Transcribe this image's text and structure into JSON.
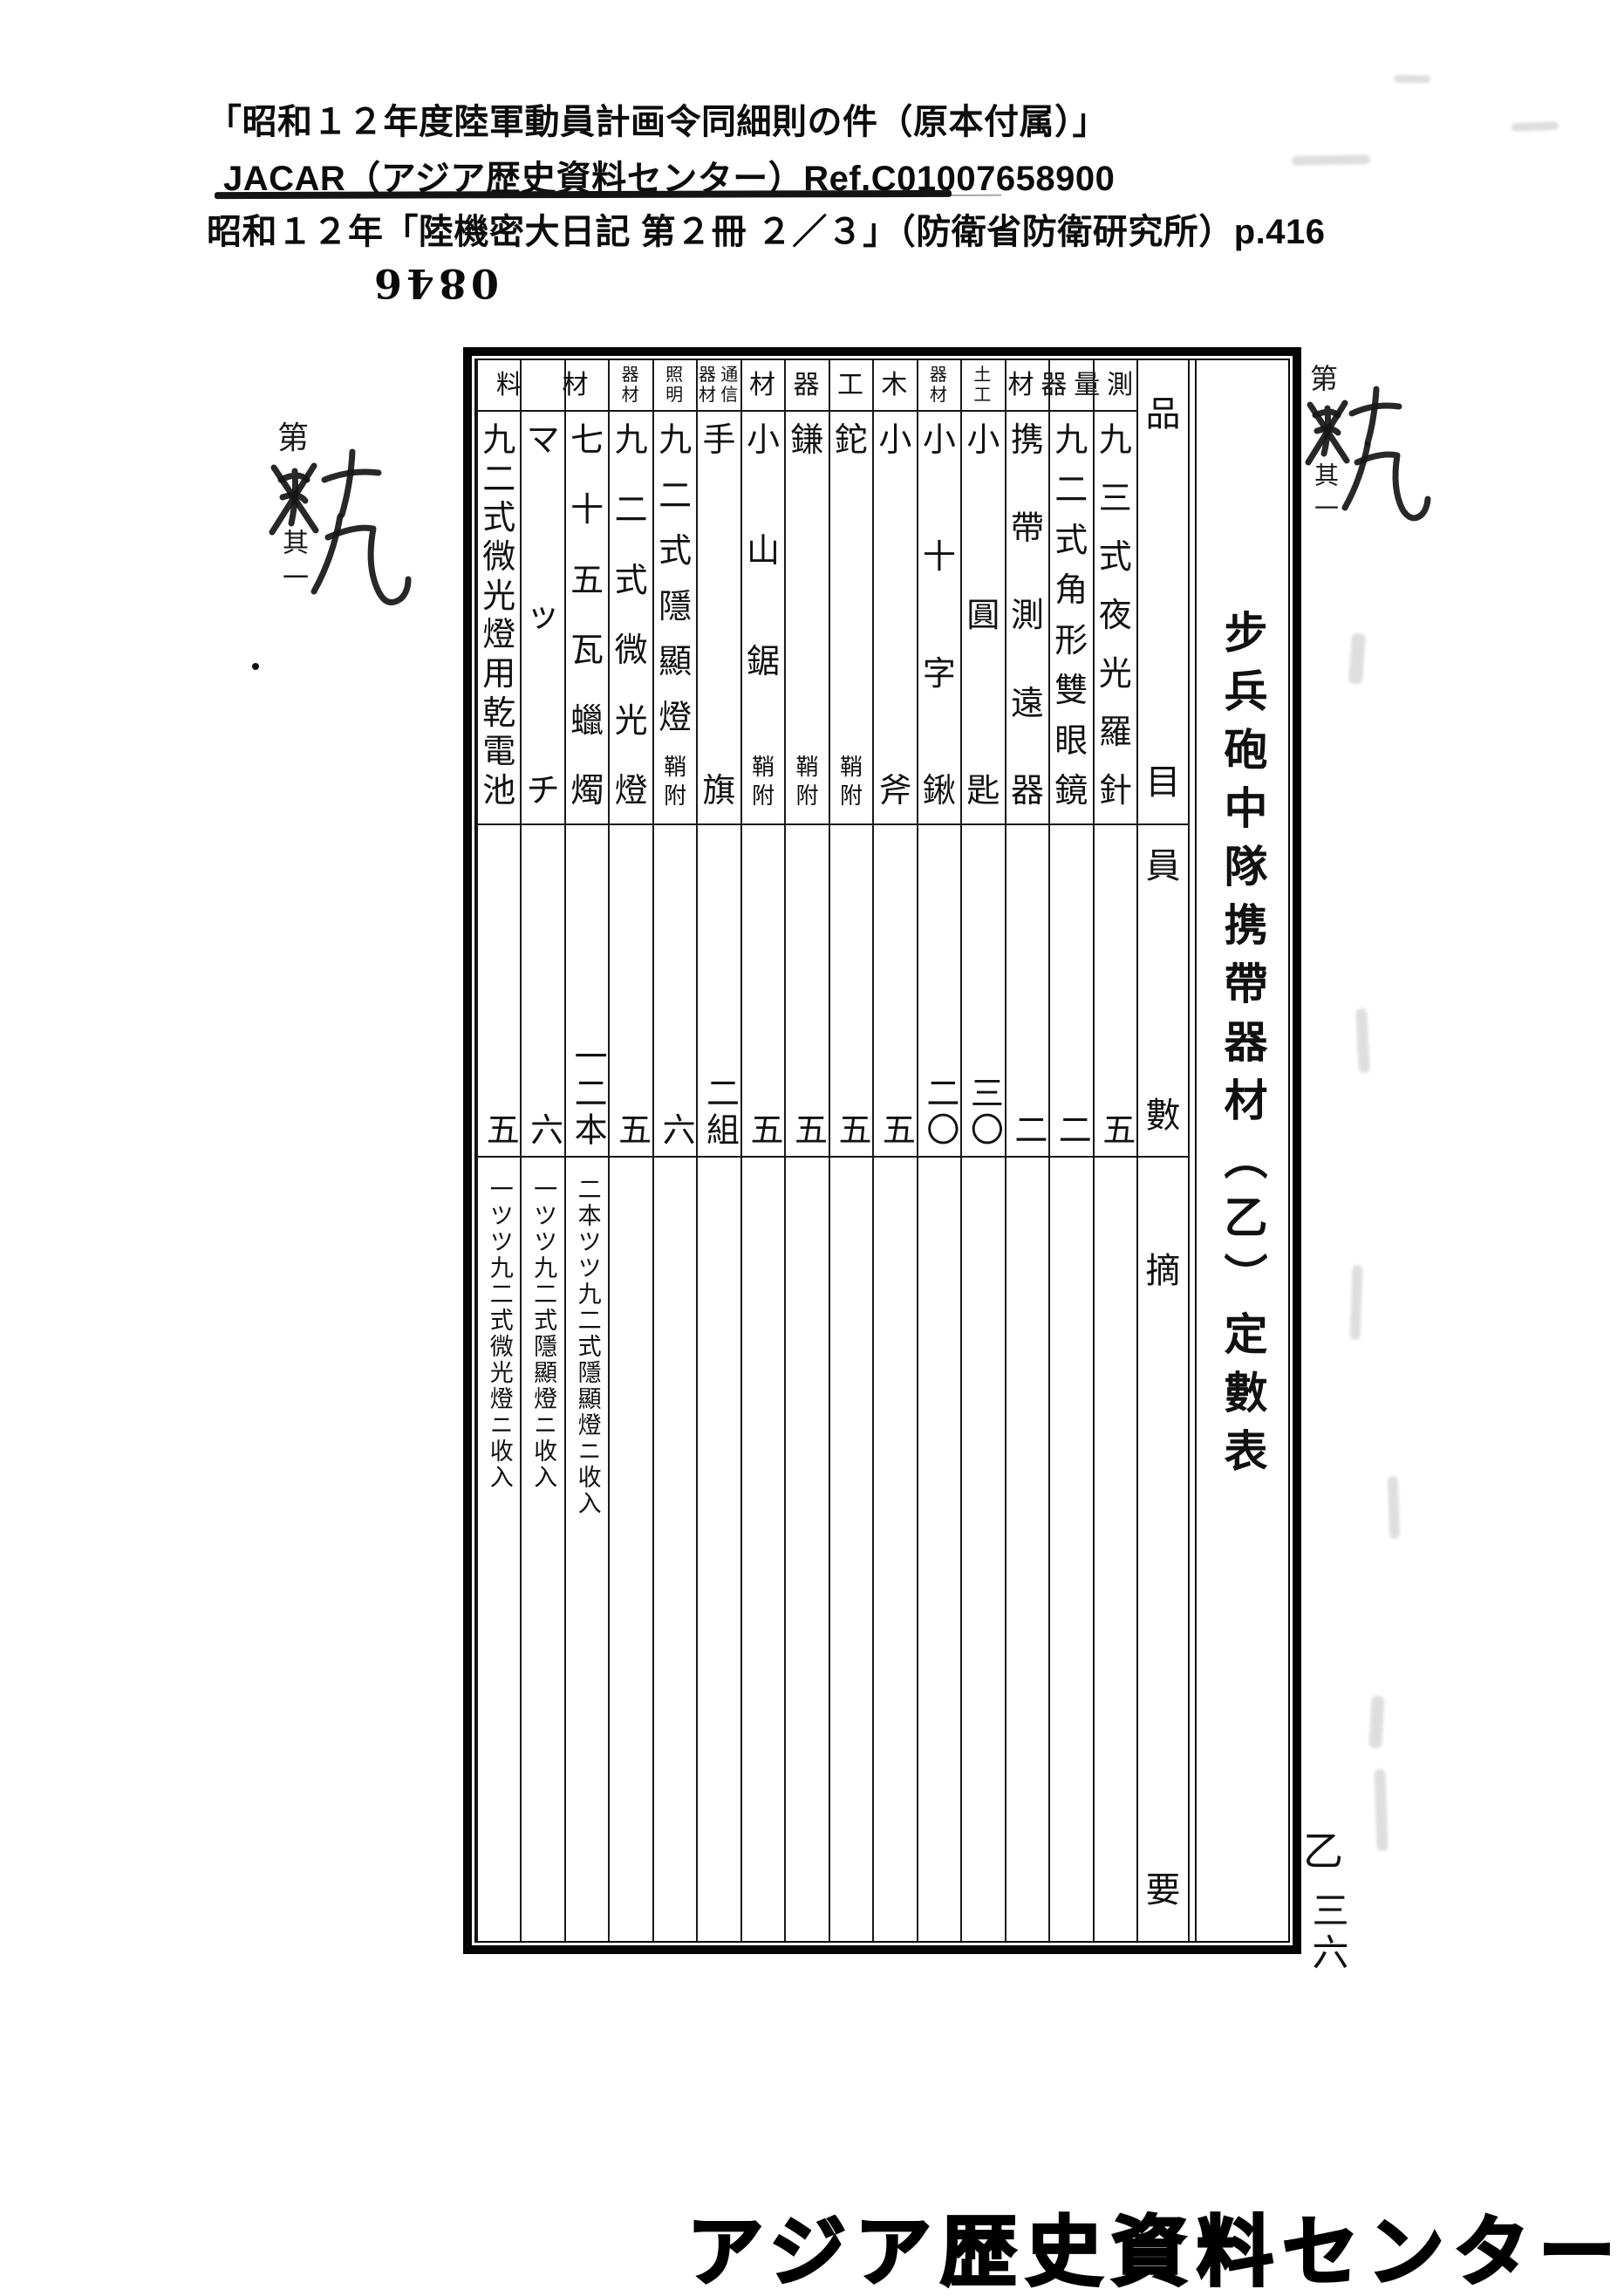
{
  "document": {
    "citation_line1": "「昭和１２年度陸軍動員計画令同細則の件（原本付属）」",
    "citation_line2": "JACAR（アジア歴史資料センター）Ref.C01007658900",
    "citation_line3": "昭和１２年「陸機密大日記 第２冊 ２／３」（防衛省防衛研究所）p.416",
    "stamp_number": "0846",
    "page_mark_series": "乙",
    "page_mark_number": "三六",
    "footer_banner": "アジア歴史資料センター",
    "margin_annotation": {
      "printed_prefix": "第",
      "printed_suffix": "其一",
      "handwritten": "十九"
    }
  },
  "table": {
    "title": "步兵砲中隊携帶器材（乙）定數表",
    "column_headers": {
      "item": "品目",
      "quantity": "員數",
      "remarks": "摘要"
    },
    "groups": [
      {
        "label": "測量器材",
        "span": 3,
        "layout": "horizontal"
      },
      {
        "label": "土工器材",
        "span": 2,
        "layout": "grid2x2"
      },
      {
        "label": "木工器材",
        "span": 4,
        "layout": "horizontal"
      },
      {
        "label": "通信器材",
        "span": 1,
        "layout": "grid2x2"
      },
      {
        "label": "照明器材",
        "span": 2,
        "layout": "grid2x2"
      },
      {
        "label": "材料",
        "span": 3,
        "layout": "horizontal"
      }
    ],
    "columns": [
      {
        "name": "九三式夜光羅針",
        "suffix": "",
        "qty": "五",
        "remark": ""
      },
      {
        "name": "九二式角形雙眼鏡",
        "suffix": "",
        "qty": "二",
        "remark": ""
      },
      {
        "name": "携帶測遠器",
        "suffix": "",
        "qty": "二",
        "remark": ""
      },
      {
        "name": "小圓匙",
        "suffix": "",
        "qty": "三〇",
        "remark": ""
      },
      {
        "name": "小十字鍬",
        "suffix": "",
        "qty": "二〇",
        "remark": ""
      },
      {
        "name": "小斧",
        "suffix": "",
        "qty": "五",
        "remark": ""
      },
      {
        "name": "鉈",
        "suffix": "鞘附",
        "qty": "五",
        "remark": ""
      },
      {
        "name": "鎌",
        "suffix": "鞘附",
        "qty": "五",
        "remark": ""
      },
      {
        "name": "小山鋸",
        "suffix": "鞘附",
        "qty": "五",
        "remark": ""
      },
      {
        "name": "手旗",
        "suffix": "",
        "qty": "二組",
        "remark": ""
      },
      {
        "name": "九二式隱顯燈",
        "suffix": "鞘附",
        "qty": "六",
        "remark": ""
      },
      {
        "name": "九二式微光燈",
        "suffix": "",
        "qty": "五",
        "remark": ""
      },
      {
        "name": "七十五瓦蠟燭",
        "suffix": "",
        "qty": "一二本",
        "remark": "二本ツツ九二式隱顯燈ニ收入"
      },
      {
        "name": "マッチ",
        "suffix": "",
        "qty": "六",
        "remark": "一ツツ九二式隱顯燈ニ收入"
      },
      {
        "name": "九二式微光燈用乾電池",
        "suffix": "",
        "qty": "五",
        "remark": "一ツツ九二式微光燈ニ收入"
      }
    ]
  }
}
